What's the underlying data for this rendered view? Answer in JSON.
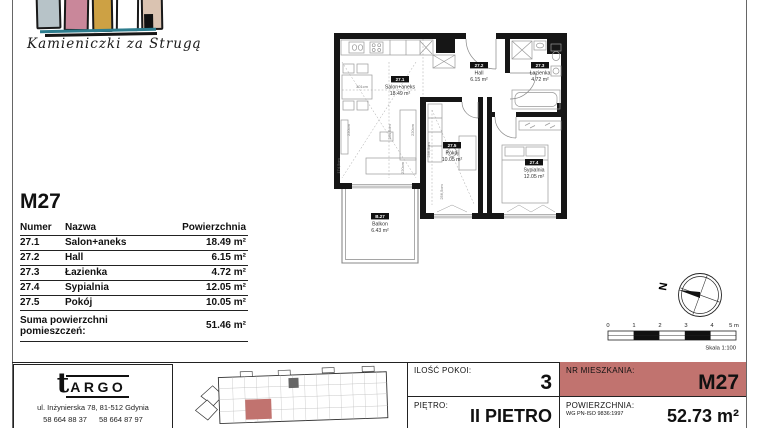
{
  "page": {
    "accent_red": "#c1736f",
    "wall_color": "#161616"
  },
  "brand": {
    "name": "Kamieniczki za Strugą",
    "house_colors": [
      "#b7c3c8",
      "#c9879a",
      "#cda144",
      "#ffffff",
      "#dac3b1"
    ]
  },
  "unit_table": {
    "title": "M27",
    "headers": {
      "num": "Numer",
      "name": "Nazwa",
      "area": "Powierzchnia"
    },
    "rows": [
      {
        "num": "27.1",
        "name": "Salon+aneks",
        "area": "18.49 m²"
      },
      {
        "num": "27.2",
        "name": "Hall",
        "area": "6.15 m²"
      },
      {
        "num": "27.3",
        "name": "Łazienka",
        "area": "4.72 m²"
      },
      {
        "num": "27.4",
        "name": "Sypialnia",
        "area": "12.05 m²"
      },
      {
        "num": "27.5",
        "name": "Pokój",
        "area": "10.05 m²"
      }
    ],
    "sum_label_line1": "Suma powierzchni",
    "sum_label_line2": "pomieszczeń:",
    "sum_value": "51.46 m²"
  },
  "plan": {
    "rooms": [
      {
        "id": "27.1",
        "name": "Salon+aneks",
        "area": "18.49 m²"
      },
      {
        "id": "27.2",
        "name": "Hall",
        "area": "6.15 m²"
      },
      {
        "id": "27.3",
        "name": "Łazienka",
        "area": "4.72 m²"
      },
      {
        "id": "27.5",
        "name": "Pokój",
        "area": "10.05 m²"
      },
      {
        "id": "27.4",
        "name": "Sypialnia",
        "area": "12.05 m²"
      },
      {
        "id": "B.27",
        "name": "Balkon",
        "area": "6.43 m²"
      }
    ],
    "dimensions": [
      "301cm",
      "220cm",
      "284,5cm",
      "220cm",
      "174,5cm",
      "220cm",
      "236,5cm",
      "256,5cm"
    ]
  },
  "compass": {
    "north_label": "N"
  },
  "scale_bar": {
    "ticks": [
      "0",
      "1",
      "2",
      "3",
      "4",
      "5 m"
    ],
    "caption": "Skala 1:100"
  },
  "footer": {
    "company": {
      "logo_t": "t",
      "logo_rest": "ARGO",
      "address": "ul. Inżynierska 78, 81-512 Gdynia",
      "phone1": "58 664 88 37",
      "phone2": "58 664 87 97"
    },
    "details": {
      "rooms_label": "ILOŚĆ POKOI:",
      "rooms_value": "3",
      "unit_label": "NR MIESZKANIA:",
      "unit_value": "M27",
      "floor_label": "PIĘTRO:",
      "floor_value": "II PIETRO",
      "area_label": "POWIERZCHNIA:",
      "area_sublabel": "WG PN-ISO 9836:1997",
      "area_value": "52.73 m²"
    }
  }
}
